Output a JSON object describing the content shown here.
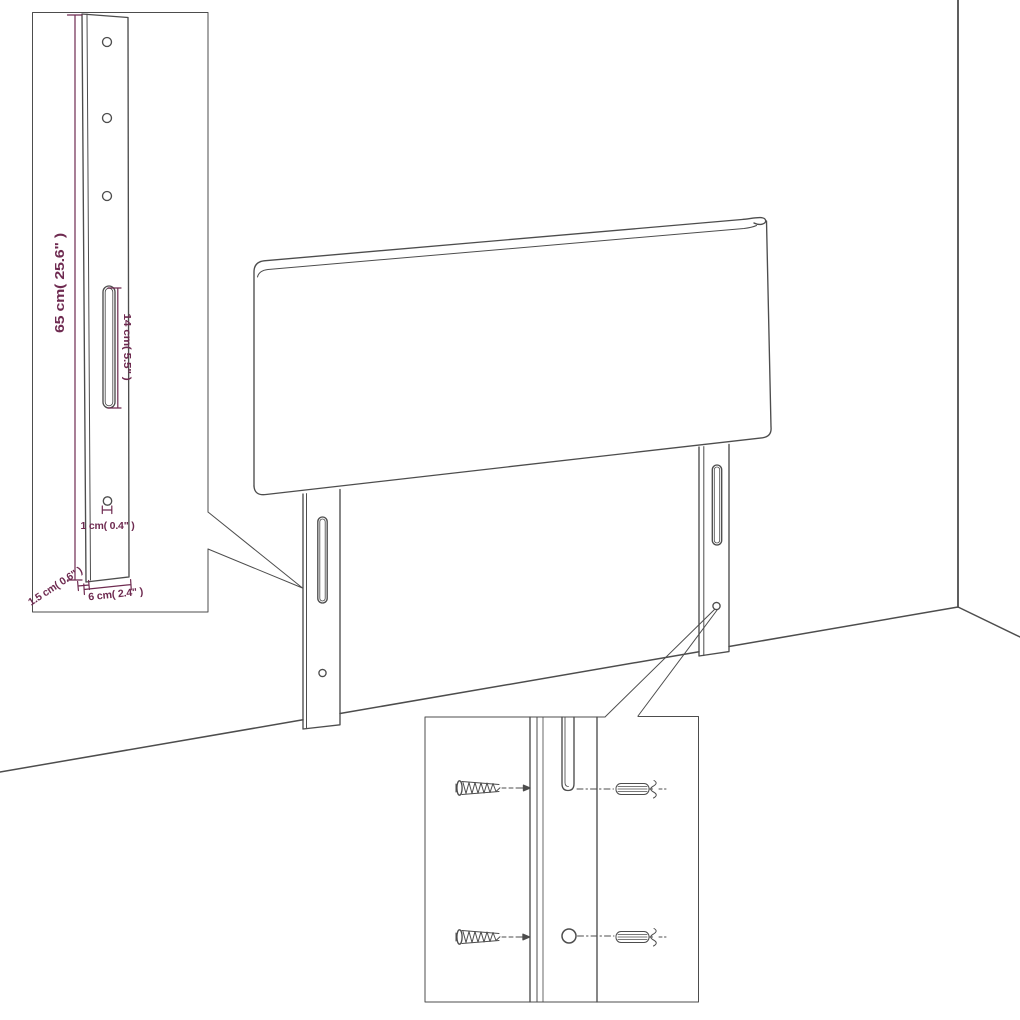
{
  "diagram": {
    "kind": "headboard dimension diagram",
    "insets": {
      "leg_detail": "mounting leg with drill holes and slot",
      "hardware_detail": "screws and wall plugs aligned to leg slot and hole"
    }
  },
  "labels": {
    "height": "65 cm( 25.6\" )",
    "slot_length": "14 cm( 5.5\" )",
    "hole_diameter": "1 cm( 0.4\" )",
    "leg_thickness": "1.5 cm( 0.6\" )",
    "leg_width": "6 cm( 2.4\" )"
  },
  "colors": {
    "background": "#ffffff",
    "line": "#4d4d4d",
    "dimension": "#6e2a50"
  }
}
